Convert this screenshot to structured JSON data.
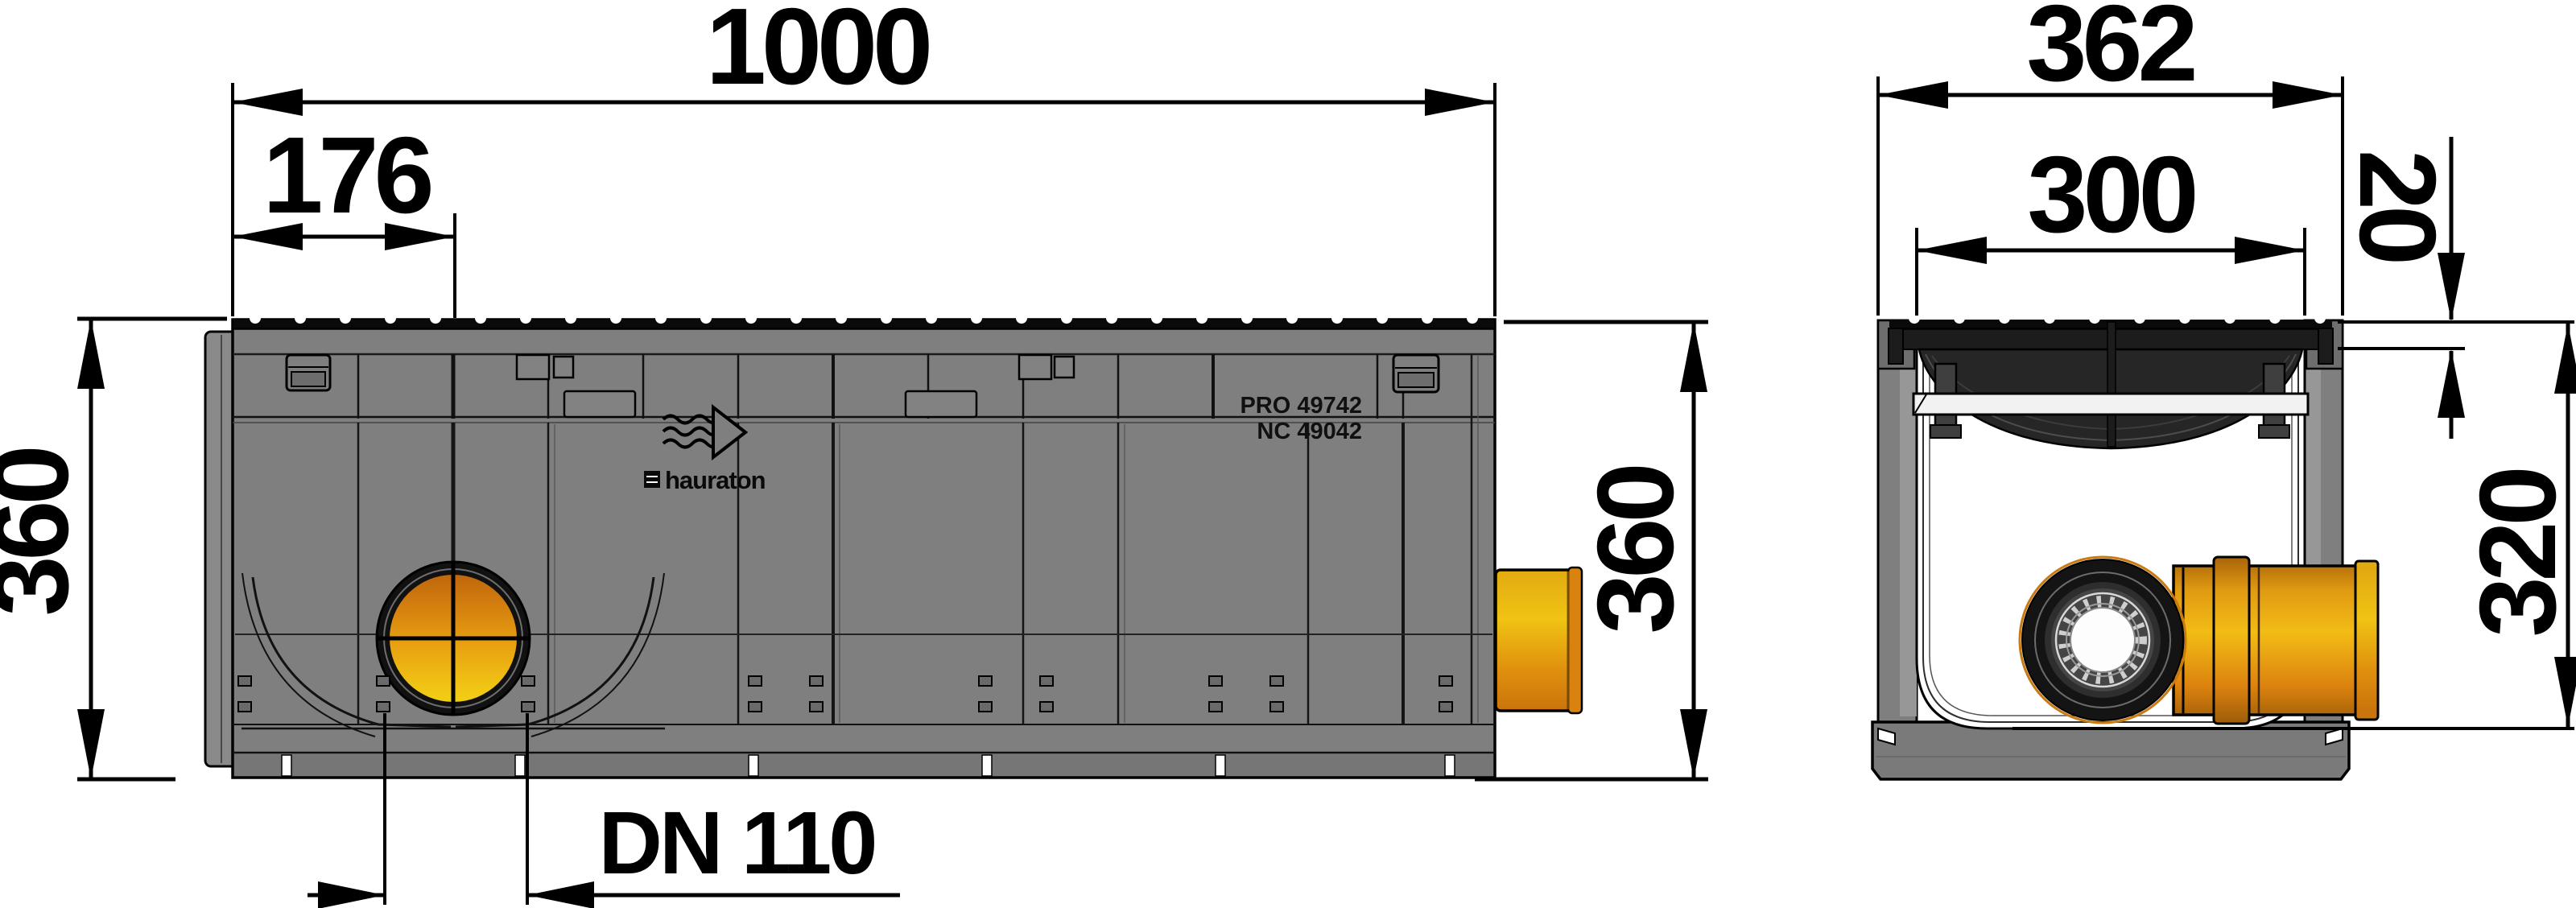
{
  "drawing": {
    "type": "technical-drawing",
    "product": "drainage channel with grating and DN 110 outlet",
    "side_view": {
      "dims": {
        "overall_length": "1000",
        "outlet_offset": "176",
        "overall_height_left": "360",
        "overall_height_right": "360",
        "outlet_diameter": "DN 110"
      },
      "markings": {
        "line1": "PRO 49742",
        "line2": "NC 49042",
        "brand": "hauraton"
      }
    },
    "cross_section": {
      "dims": {
        "overall_width": "362",
        "clear_width": "300",
        "grate_thickness": "20",
        "inner_depth": "320"
      }
    },
    "colors": {
      "body_gray": "#7f7f7f",
      "grate_dark": "#1c1c1c",
      "pipe_orange": "#df8f0e",
      "pipe_yellow": "#f0c313",
      "line_black": "#000000",
      "frame_white": "#f2f2f2"
    }
  }
}
